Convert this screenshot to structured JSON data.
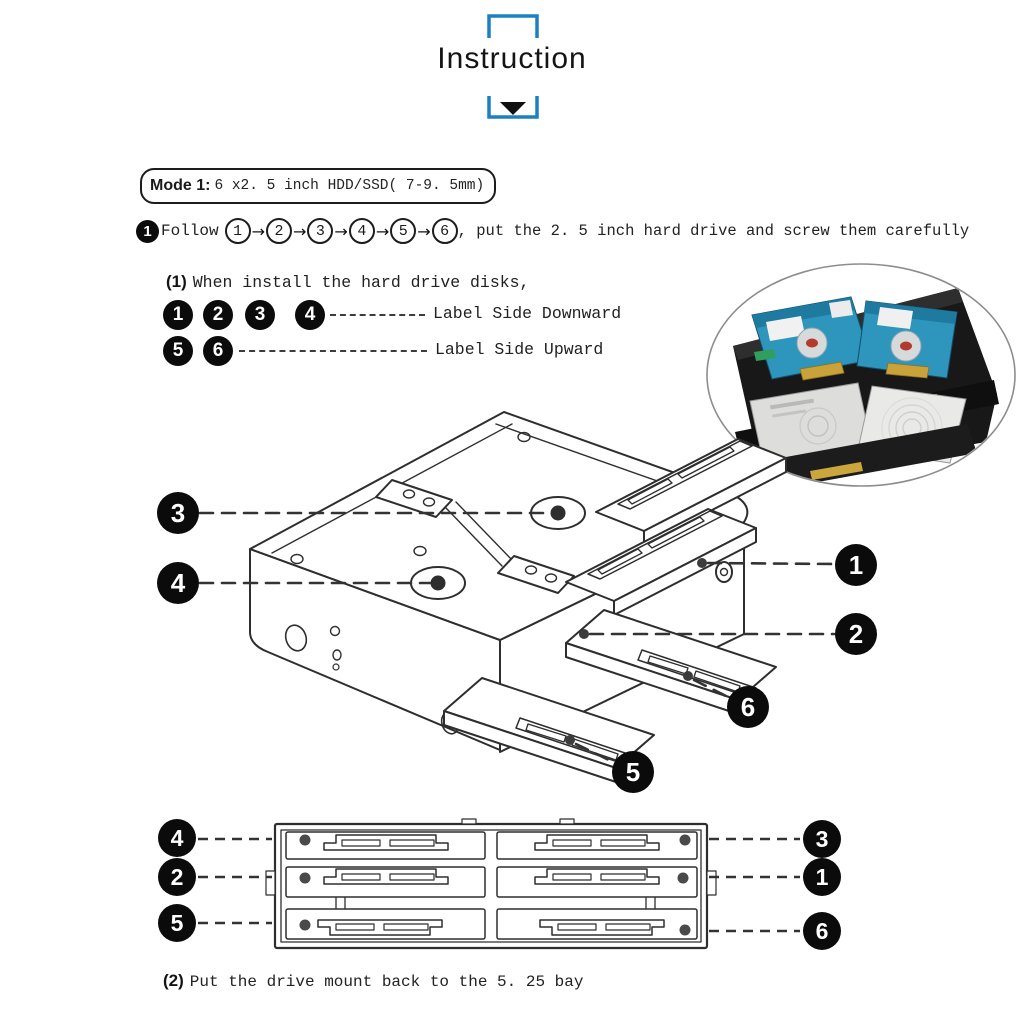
{
  "header": {
    "title": "Instruction"
  },
  "mode_box": {
    "prefix": "Mode 1:",
    "text": "6 x2. 5 inch HDD/SSD( 7-9. 5mm)"
  },
  "step1": {
    "badge": "1",
    "label": "Follow",
    "arrow": "→",
    "sequence": [
      "1",
      "2",
      "3",
      "4",
      "5",
      "6"
    ],
    "suffix": ", put the 2. 5 inch hard drive and screw them carefully"
  },
  "substep1": {
    "prefix": "(1)",
    "text": "When install the hard drive disks,",
    "row_down": {
      "badges": [
        "1",
        "2",
        "3",
        "4"
      ],
      "label": "Label Side Downward"
    },
    "row_up": {
      "badges": [
        "5",
        "6"
      ],
      "label": "Label Side Upward"
    }
  },
  "substep2": {
    "prefix": "(2)",
    "text": "Put the drive mount back to the 5. 25 bay"
  },
  "iso_diagram": {
    "callouts": {
      "c3": "3",
      "c4": "4",
      "c1": "1",
      "c2": "2",
      "c6": "6",
      "c5": "5"
    }
  },
  "front_diagram": {
    "left": [
      "4",
      "2",
      "5"
    ],
    "right": [
      "3",
      "1",
      "6"
    ]
  },
  "colors": {
    "accent_blue": "#1d7fc1",
    "line": "#2e2e2e",
    "drive_blue": "#2e95bd",
    "drive_silver": "#dddddc",
    "badge_black": "#0b0b0b"
  }
}
